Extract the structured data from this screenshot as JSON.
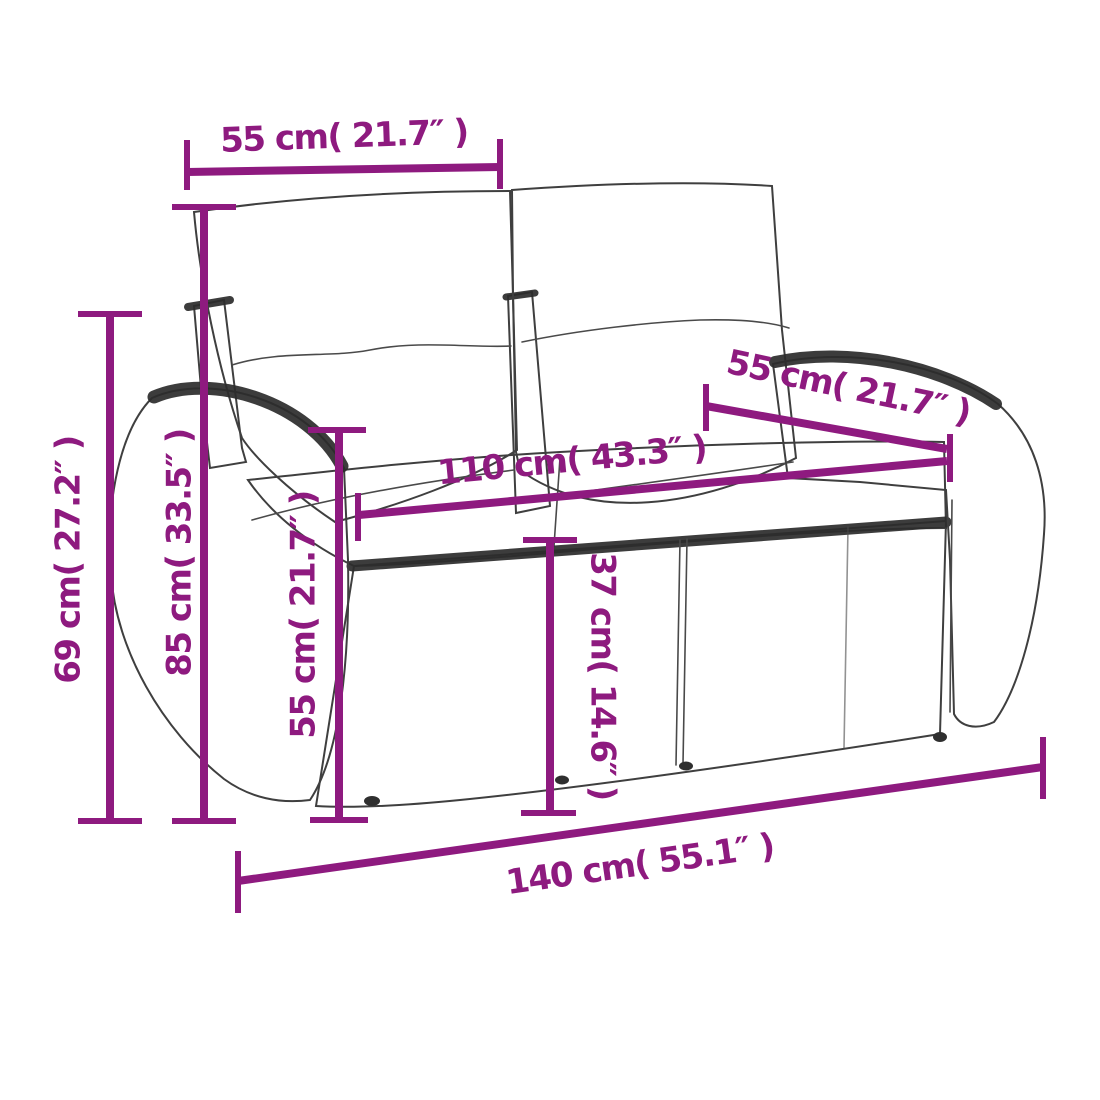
{
  "diagram": {
    "title": "Poly rattan 2-seater garden sofa — dimension drawing",
    "colors": {
      "dimension_annotation": "#8e1a7f",
      "line_art": "#3f3f3f",
      "background": "#ffffff"
    },
    "dimensions": {
      "seat_width_top": {
        "label": "55 cm( 21.7″ )"
      },
      "armrest_depth_right": {
        "label": "55 cm( 21.7″ )"
      },
      "inner_seat_width": {
        "label": "110 cm( 43.3″ )"
      },
      "overall_height": {
        "label": "69 cm( 27.2″ )"
      },
      "overall_depth": {
        "label": "85 cm( 33.5″ )"
      },
      "back_height": {
        "label": "55 cm( 21.7″ )"
      },
      "seat_height": {
        "label": "37 cm( 14.6″ )"
      },
      "overall_width": {
        "label": "140 cm( 55.1″ )"
      }
    }
  }
}
